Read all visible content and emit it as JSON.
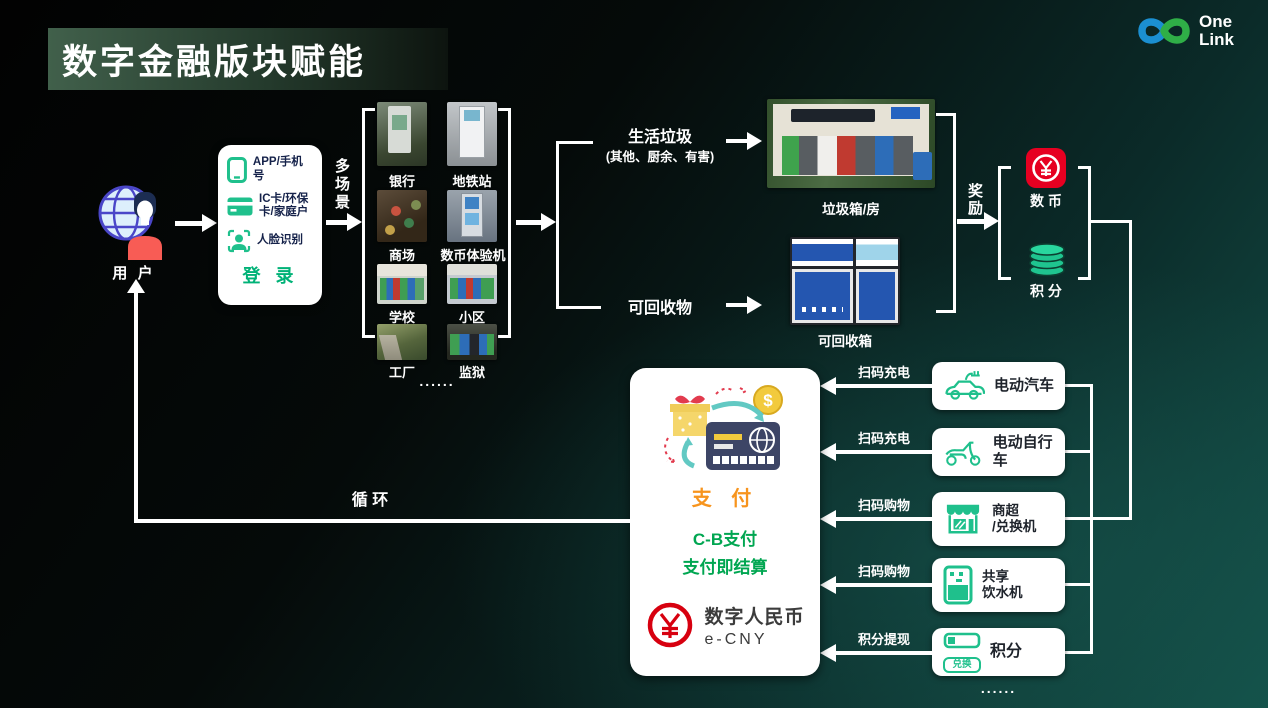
{
  "header": {
    "title": "数字金融版块赋能",
    "logo_line1": "One",
    "logo_line2": "Link"
  },
  "user": {
    "label": "用 户"
  },
  "login": {
    "items": [
      {
        "icon": "phone-icon",
        "label": "APP/手机号"
      },
      {
        "icon": "ic-card-icon",
        "label": "IC卡/环保\n卡/家庭户"
      },
      {
        "icon": "face-recognition-icon",
        "label": "人脸识别"
      }
    ],
    "action": "登 录"
  },
  "labels": {
    "multi_scene": "多场景",
    "reward": "奖励",
    "cycle": "循 环"
  },
  "scenes": {
    "items": [
      {
        "label": "银行"
      },
      {
        "label": "地铁站"
      },
      {
        "label": "商场"
      },
      {
        "label": "数币体验机"
      },
      {
        "label": "学校"
      },
      {
        "label": "小区"
      },
      {
        "label": "工厂"
      },
      {
        "label": "监狱"
      }
    ],
    "more": "......"
  },
  "waste": {
    "household": "生活垃圾",
    "household_sub": "(其他、厨余、有害)",
    "recyclable": "可回收物",
    "bin_house": "垃圾箱/房",
    "recycle_box": "可回收箱"
  },
  "reward_targets": {
    "coin": "数 币",
    "points": "积 分"
  },
  "payment_box": {
    "pay": "支 付",
    "cb_line1": "C-B支付",
    "cb_line2": "支付即结算",
    "ecny_cn": "数字人民币",
    "ecny_en": "e-CNY"
  },
  "right_boxes": {
    "items": [
      {
        "icon": "ev-car-icon",
        "label": "电动汽车",
        "arrow": "扫码充电"
      },
      {
        "icon": "ev-bike-icon",
        "label": "电动自行车",
        "arrow": "扫码充电"
      },
      {
        "icon": "store-icon",
        "label": "商超\n/兑换机",
        "arrow": "扫码购物"
      },
      {
        "icon": "water-dispenser-icon",
        "label": "共享\n饮水机",
        "arrow": "扫码购物"
      },
      {
        "icon": "points-exchange-icon",
        "label": "积分",
        "arrow": "积分提现",
        "badge": "兑换"
      }
    ],
    "more": "......"
  },
  "colors": {
    "accent_green": "#1fc08c",
    "ecny_red": "#e60021",
    "pay_orange": "#f7941d",
    "cb_green": "#00a651",
    "panel_blue": "#2456b0"
  }
}
